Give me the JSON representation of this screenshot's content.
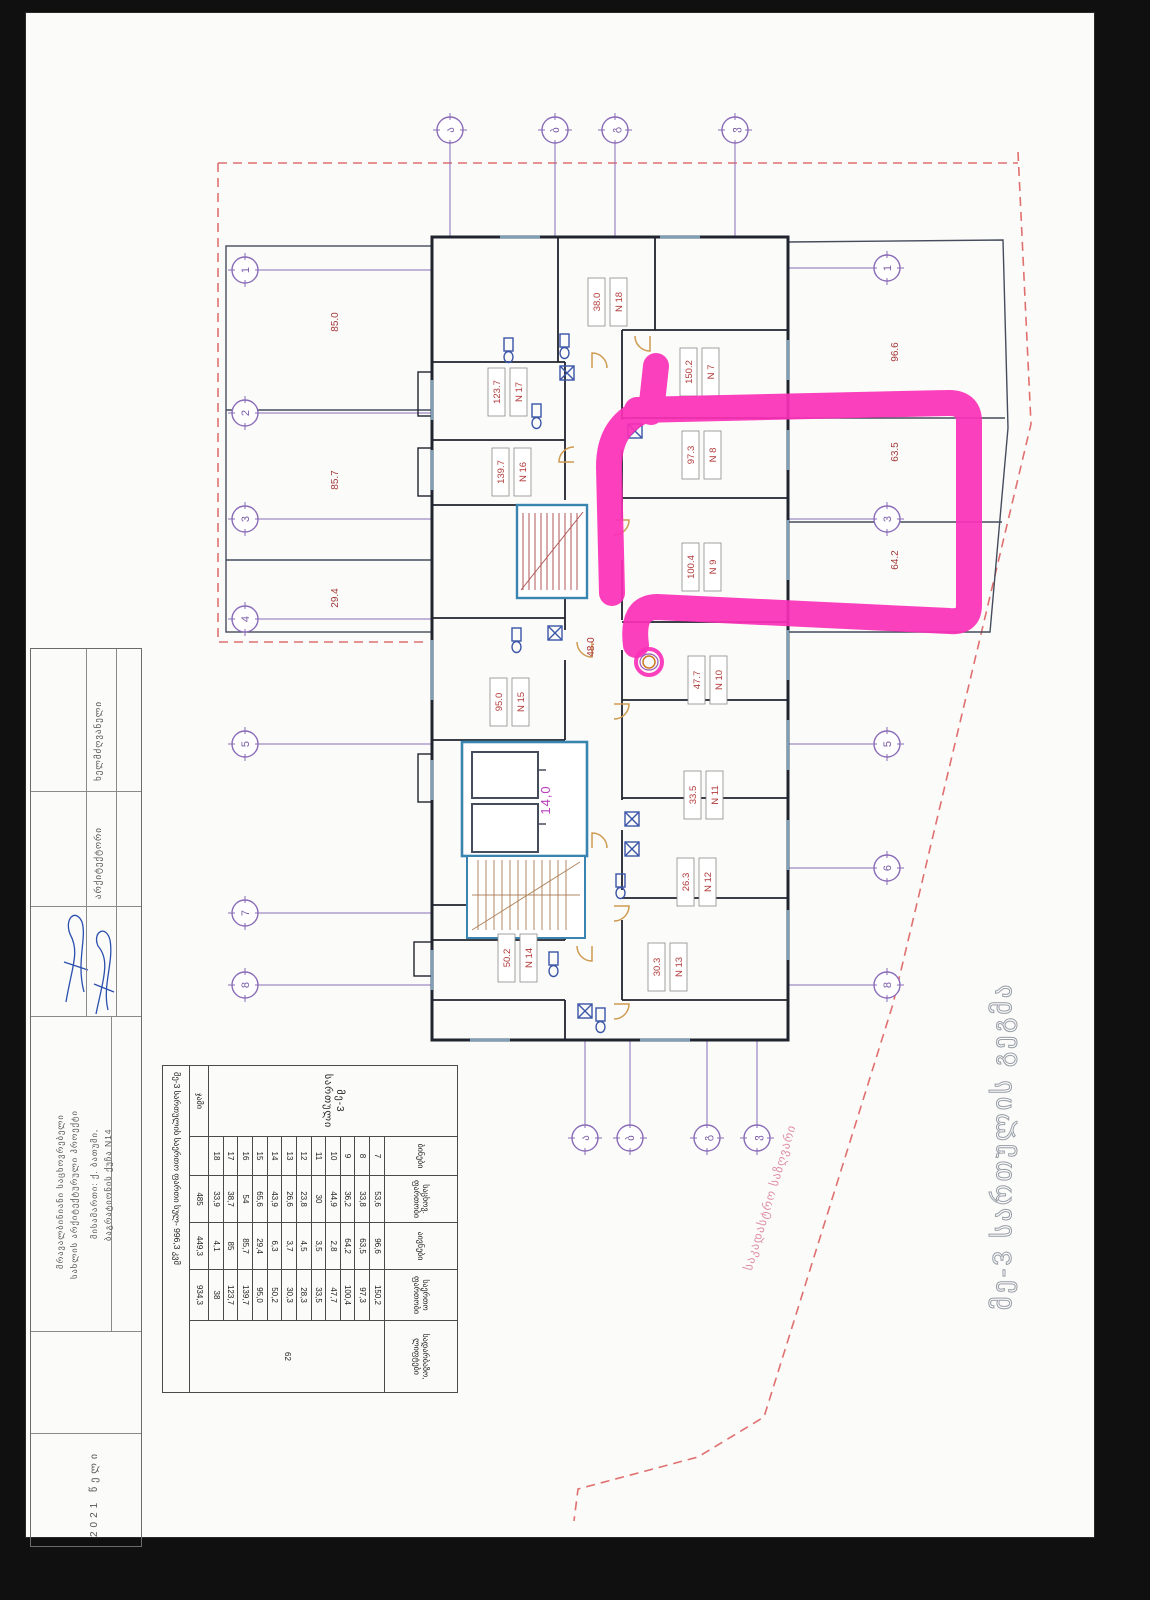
{
  "colors": {
    "paper": "#fbfbf9",
    "wall": "#20242e",
    "core_cyan": "#3a85b0",
    "stair_red": "#b05555",
    "stair_sepia": "#b08660",
    "label_red": "#b23b3b",
    "magenta_note": "#bb3fbb",
    "grid_purple": "#8a6bb8",
    "boundary_red_dash": "#e07070",
    "annotation_pink": "#fb30b8",
    "fixture_blue": "#3a55a8",
    "door_tan": "#cf9b52",
    "signature_blue": "#2a4fae"
  },
  "plan": {
    "outline_title": "მე-3 სართულის გეგმა",
    "boundary_label": "საკადასტრო საზღვარი",
    "corridor_area": "48.0",
    "lobby_area": "14,0",
    "apartments": [
      {
        "id": "N 7",
        "area": "150.2",
        "x": 700,
        "y": 372
      },
      {
        "id": "N 8",
        "area": "97.3",
        "x": 702,
        "y": 455
      },
      {
        "id": "N 9",
        "area": "100.4",
        "x": 702,
        "y": 567
      },
      {
        "id": "N 10",
        "area": "47.7",
        "x": 708,
        "y": 680
      },
      {
        "id": "N 11",
        "area": "33.5",
        "x": 704,
        "y": 795
      },
      {
        "id": "N 12",
        "area": "26.3",
        "x": 697,
        "y": 882
      },
      {
        "id": "N 13",
        "area": "30.3",
        "x": 668,
        "y": 967
      },
      {
        "id": "N 14",
        "area": "50.2",
        "x": 518,
        "y": 958
      },
      {
        "id": "N 15",
        "area": "95.0",
        "x": 510,
        "y": 702
      },
      {
        "id": "N 16",
        "area": "139.7",
        "x": 512,
        "y": 472
      },
      {
        "id": "N 17",
        "area": "123.7",
        "x": 508,
        "y": 392
      },
      {
        "id": "N 18",
        "area": "38.0",
        "x": 608,
        "y": 302
      }
    ],
    "open_areas": [
      {
        "area": "85.0",
        "x": 338,
        "y": 322
      },
      {
        "area": "85.7",
        "x": 338,
        "y": 480
      },
      {
        "area": "29.4",
        "x": 338,
        "y": 598
      },
      {
        "area": "96.6",
        "x": 898,
        "y": 352
      },
      {
        "area": "63.5",
        "x": 898,
        "y": 452
      },
      {
        "area": "64.2",
        "x": 898,
        "y": 560
      }
    ],
    "grid": {
      "left": {
        "x": 245,
        "items": [
          {
            "label": "1",
            "y": 270
          },
          {
            "label": "2",
            "y": 413
          },
          {
            "label": "3",
            "y": 519
          },
          {
            "label": "4",
            "y": 619
          },
          {
            "label": "5",
            "y": 744
          },
          {
            "label": "7",
            "y": 913
          },
          {
            "label": "8",
            "y": 985
          }
        ]
      },
      "right": {
        "x": 887,
        "items": [
          {
            "label": "1",
            "y": 268
          },
          {
            "label": "3",
            "y": 519
          },
          {
            "label": "5",
            "y": 744
          },
          {
            "label": "6",
            "y": 868
          },
          {
            "label": "8",
            "y": 985
          }
        ]
      },
      "top": {
        "y": 130,
        "items": [
          {
            "label": "ა",
            "x": 450
          },
          {
            "label": "ბ",
            "x": 555
          },
          {
            "label": "გ",
            "x": 615
          },
          {
            "label": "ვ",
            "x": 735
          }
        ]
      },
      "bottom": {
        "y": 1138,
        "items": [
          {
            "label": "ა",
            "x": 585
          },
          {
            "label": "ბ",
            "x": 630
          },
          {
            "label": "გ",
            "x": 707
          },
          {
            "label": "ვ",
            "x": 757
          }
        ]
      }
    }
  },
  "table": {
    "floor_title": "მე-3 სართული",
    "col_headers": [
      "ბინები",
      "საცხოვ.\nფართობი",
      "აივნები",
      "საერთო\nფართობი",
      "სადარბაზო,\nლიფტები"
    ],
    "rows": [
      [
        "7",
        "53,6",
        "96,6",
        "150,2"
      ],
      [
        "8",
        "33,8",
        "63,5",
        "97,3"
      ],
      [
        "9",
        "36,2",
        "64,2",
        "100,4"
      ],
      [
        "10",
        "44,9",
        "2,8",
        "47,7"
      ],
      [
        "11",
        "30",
        "3,5",
        "33,5"
      ],
      [
        "12",
        "23,8",
        "4,5",
        "28,3"
      ],
      [
        "13",
        "26,6",
        "3,7",
        "30,3"
      ],
      [
        "14",
        "43,9",
        "6,3",
        "50,2"
      ],
      [
        "15",
        "65,6",
        "29,4",
        "95,0"
      ],
      [
        "16",
        "54",
        "85,7",
        "139,7"
      ],
      [
        "17",
        "38,7",
        "85",
        "123,7"
      ],
      [
        "18",
        "33,9",
        "4,1",
        "38"
      ]
    ],
    "totals_label": "ჯამი",
    "totals": [
      "485",
      "449,3",
      "934,3"
    ],
    "common_value": "62",
    "note": "მე-3 სართულის საერთო ფართი სულ- 996,3 კვმ"
  },
  "title_block": {
    "label_1": "ხელმძღვანელი",
    "label_2": "არქიტექტორი",
    "project_line_1": "მრავალბინიანი საცხოვრებელი",
    "project_line_2": "სახლის არქიტექტურული პროექტი",
    "address_line_1": "მისამართი: ქ. ბათუმი,",
    "address_line_2": "ბაგრატიონის ქუჩა N14",
    "year": "2021 წელი"
  }
}
